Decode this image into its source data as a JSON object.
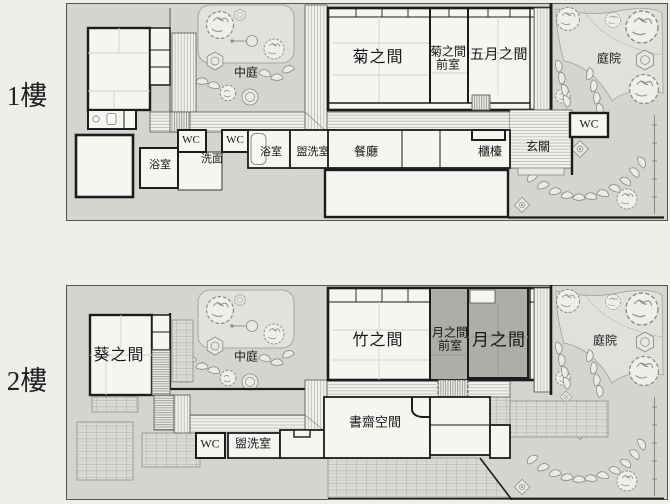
{
  "floor1": {
    "label": "1樓",
    "rooms": {
      "courtyard": "中庭",
      "kiku": "菊之間",
      "kiku_ante_line1": "菊之間",
      "kiku_ante_line2": "前室",
      "satsuki": "五月之間",
      "garden": "庭院",
      "wc_entry": "WC",
      "entrance": "玄關",
      "counter": "櫃檯",
      "dining": "餐廳",
      "washroom": "盥洗室",
      "bath_main": "浴室",
      "wc_center": "WC",
      "washbasin": "洗面",
      "wc_west": "WC",
      "bath_west": "浴室"
    }
  },
  "floor2": {
    "label": "2樓",
    "rooms": {
      "aoi": "葵之間",
      "courtyard": "中庭",
      "take": "竹之間",
      "tsuki_ante_line1": "月之間",
      "tsuki_ante_line2": "前室",
      "tsuki": "月之間",
      "garden": "庭院",
      "study": "書齋空間",
      "wc": "WC",
      "washroom": "盥洗室"
    }
  },
  "colors": {
    "page_bg": "#f0eeea",
    "site_bg": "#d6d4d0",
    "room_fill": "#f6f5f2",
    "wall": "#1c1c1c",
    "highlight_room": "#aeada9",
    "garden_path": "#e1e0dc",
    "label_text": "#171717"
  }
}
